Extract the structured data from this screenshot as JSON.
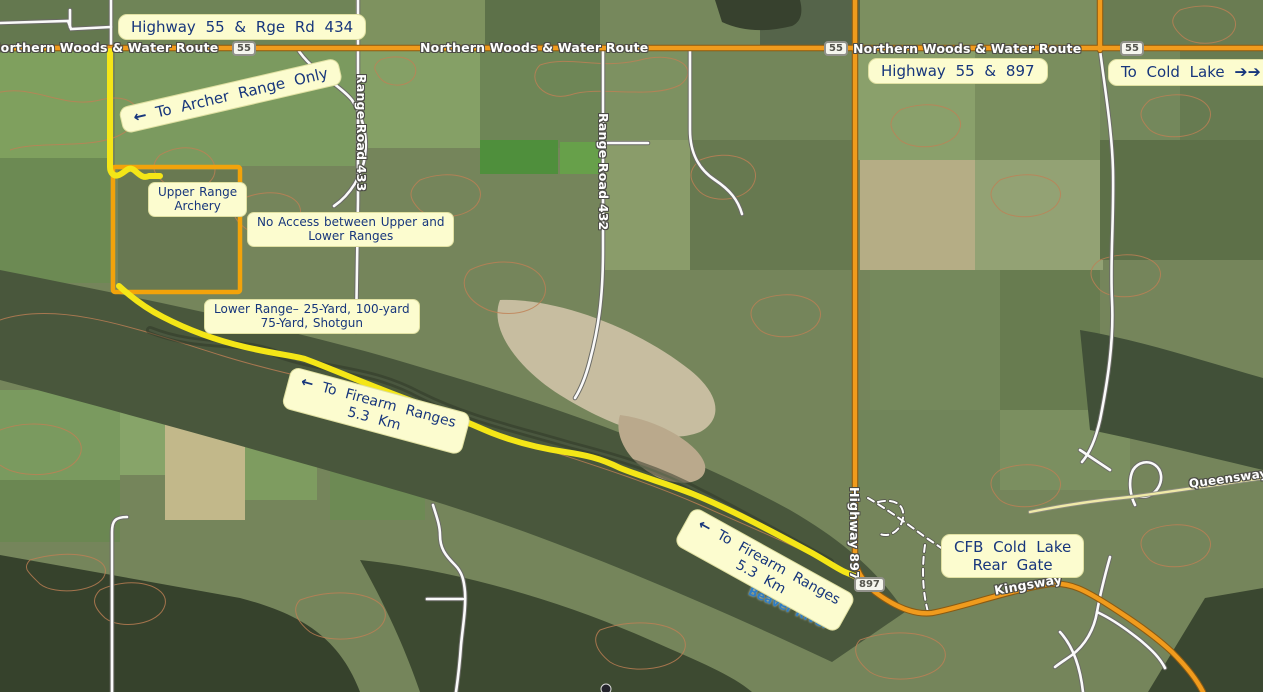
{
  "callouts": {
    "hwy55_rge434": {
      "text": "Highway 55 & Rge Rd 434"
    },
    "archer": {
      "arrow": "←",
      "text": "To Archer Range Only"
    },
    "upper_range": {
      "line1": "Upper Range",
      "line2": "Archery"
    },
    "no_access": {
      "line1": "No Access between Upper and",
      "line2": "Lower Ranges"
    },
    "lower_range": {
      "line1": "Lower Range– 25-Yard, 100-yard",
      "line2": "75-Yard, Shotgun"
    },
    "firearm_1": {
      "arrow": "←",
      "line1": "To Firearm Ranges",
      "line2": "5.3 Km"
    },
    "firearm_2": {
      "arrow": "←",
      "line1": "To Firearm Ranges",
      "line2": "5.3 Km"
    },
    "hwy55_897": {
      "text": "Highway 55 & 897"
    },
    "cold_lake": {
      "text": "To Cold Lake",
      "arrows": "➔➔"
    },
    "cfb_gate": {
      "line1": "CFB Cold Lake",
      "line2": "Rear Gate"
    }
  },
  "road_labels": {
    "northern_woods": "Northern Woods & Water Route",
    "range_road_433": "Range Road 433",
    "range_road_432": "Range Road 432",
    "highway_897": "Highway 897",
    "kingsway": "Kingsway",
    "queensway": "Queensway",
    "beaver_river": "Beaver River"
  },
  "shields": {
    "hwy_55": "55",
    "hwy_897": "897"
  },
  "colors": {
    "route_highlight": "#f4e617",
    "range_boundary": "#f2a30b",
    "highway_orange": "#f09b1d",
    "callout_bg": "#fcfccf",
    "callout_text": "#17367c",
    "contour": "#c08055"
  }
}
